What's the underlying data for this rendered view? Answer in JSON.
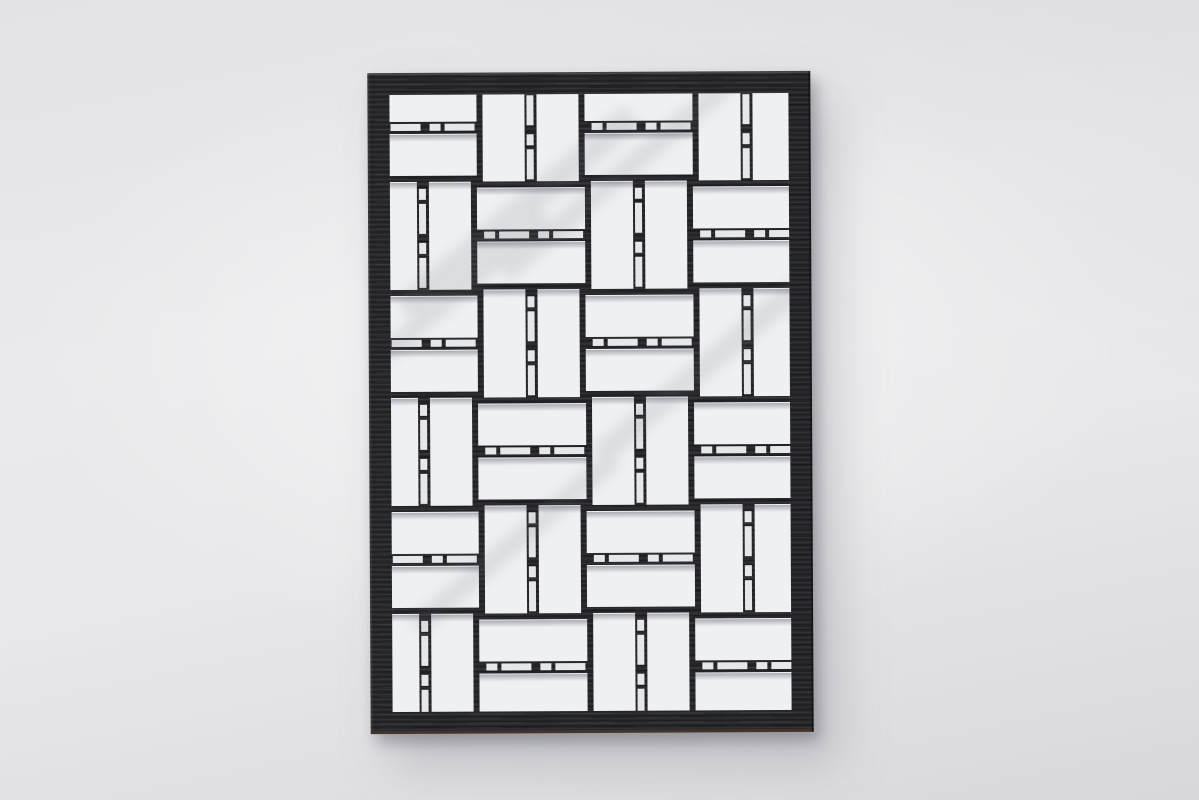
{
  "scene": {
    "type": "photograph",
    "subject": "black laser-cut wooden panel with basket-weave lattice pattern",
    "setting": "light gray seamless studio backdrop",
    "visible_text": "none"
  },
  "palette": {
    "backdrop_center": "#efeff1",
    "backdrop_edge": "#d8d8db",
    "panel_black": "#28282c",
    "hole_white": "#eef0f2",
    "bead_white": "#e6e7ea",
    "hole_shadow_gray": "#80808a",
    "soft_streak_gray": "#707078",
    "panel_bottom_edge_brown": "#4a372c",
    "cast_shadow": "rgba(110,110,120,0.45)"
  },
  "panel": {
    "left": 369,
    "top": 72,
    "width": 443,
    "height": 661,
    "frame_thickness": 22,
    "tilt_deg": -0.3
  },
  "weave": {
    "pitch": 54,
    "hole_width": 42,
    "end_extension": 5,
    "origin_x": -16,
    "origin_y": -16,
    "cols": 9,
    "rows": 13,
    "bead_thickness": 7,
    "bead_segments": [
      [
        2,
        11
      ],
      [
        17,
        30
      ]
    ],
    "sliver_height": 7,
    "grout": 1
  },
  "streaks": [
    {
      "x": 150,
      "y": 140,
      "w": 300,
      "h": 26,
      "rot": -40
    },
    {
      "x": 250,
      "y": 105,
      "w": 300,
      "h": 20,
      "rot": -40
    },
    {
      "x": 95,
      "y": 215,
      "w": 220,
      "h": 18,
      "rot": -40
    },
    {
      "x": 330,
      "y": 300,
      "w": 260,
      "h": 22,
      "rot": -40
    },
    {
      "x": 145,
      "y": 470,
      "w": 260,
      "h": 20,
      "rot": -40
    }
  ]
}
